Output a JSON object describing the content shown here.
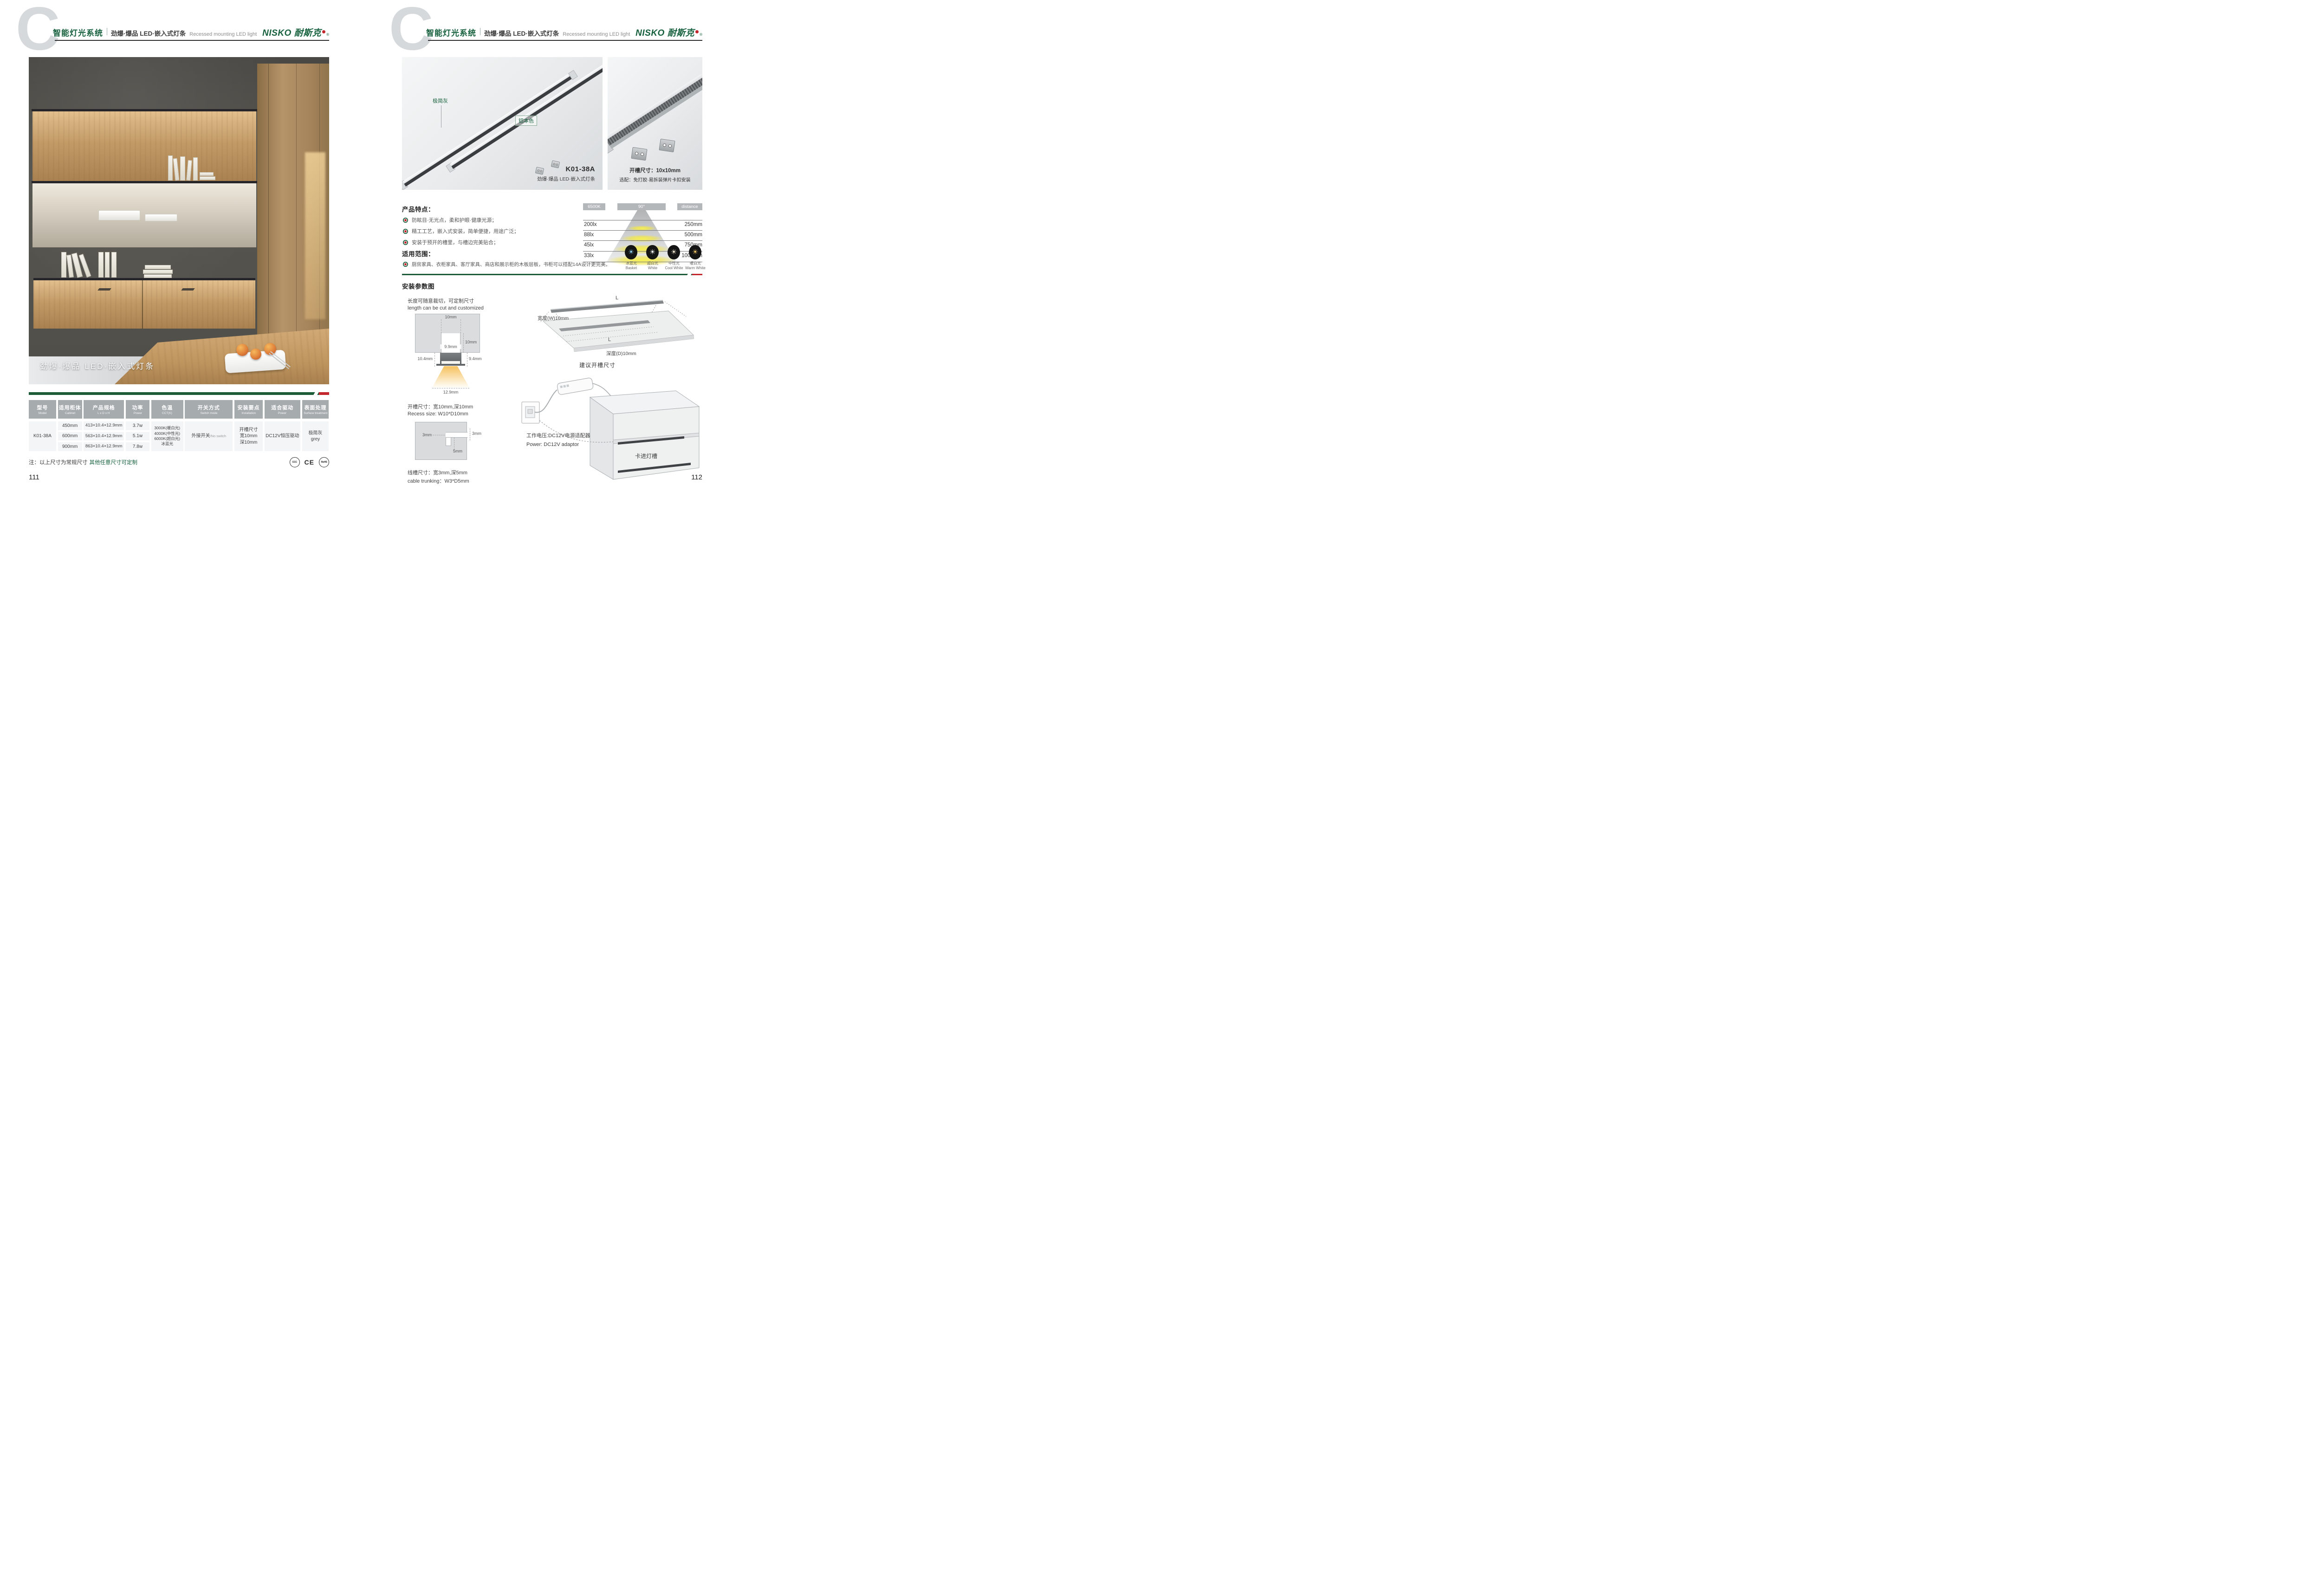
{
  "header": {
    "c_mark": "C",
    "title_zh": "智能灯光系统",
    "title_sub": "劲爆·爆品  LED·嵌入式灯条",
    "title_en": "Recessed mounting LED light",
    "logo_text": "NISKO 耐斯克",
    "logo_reg": "®"
  },
  "colors": {
    "brand_green": "#17613e",
    "accent_red": "#c1272d",
    "header_gray": "#a6abae",
    "cell_bg": "#f3f5f6"
  },
  "page_left": {
    "photo_caption": "劲爆·爆品 LED·嵌入式灯条",
    "table": {
      "headers": [
        {
          "zh": "型号",
          "en": "Model"
        },
        {
          "zh": "适用柜体",
          "en": "Cabinet"
        },
        {
          "zh": "产品规格",
          "en": "L x D x H"
        },
        {
          "zh": "功率",
          "en": "Power"
        },
        {
          "zh": "色温",
          "en": "CCT(K)"
        },
        {
          "zh": "开关方式",
          "en": "Switch mode"
        },
        {
          "zh": "安装要点",
          "en": "Installation"
        },
        {
          "zh": "适合驱动",
          "en": "Power"
        },
        {
          "zh": "表面处理",
          "en": "Surface treatment"
        }
      ],
      "model": "K01-38A",
      "variants": [
        {
          "cabinet": "450mm",
          "spec": "413×10.4×12.9mm",
          "power": "3.7w"
        },
        {
          "cabinet": "600mm",
          "spec": "563×10.4×12.9mm",
          "power": "5.1w"
        },
        {
          "cabinet": "900mm",
          "spec": "863×10.4×12.9mm",
          "power": "7.8w"
        }
      ],
      "cct_lines": [
        "3000K(暖白光)",
        "4000K(中性光)",
        "6000K(超白光)",
        "冰蓝光"
      ],
      "switch_zh": "外接开关",
      "switch_en": "/No switch",
      "install_lines": [
        "开槽尺寸",
        "宽10mm",
        "深10mm"
      ],
      "driver": "DC12V恒压驱动",
      "surface_lines": [
        "极简灰",
        "grey"
      ]
    },
    "note_prefix": "注：以上尺寸为常规尺寸",
    "note_green": "其他任意尺寸可定制",
    "certs": [
      "CCC",
      "CE",
      "RoHS"
    ],
    "page_number": "111"
  },
  "page_right": {
    "panel_main": {
      "label_gray": "极简灰",
      "label_aluminum": "铝本色",
      "model": "K01-38A",
      "model_sub": "劲爆·爆品 LED·嵌入式灯条"
    },
    "panel_detail": {
      "line1": "开槽尺寸：10x10mm",
      "line2": "选配：免打胶·易拆装弹片卡扣安装"
    },
    "features": {
      "title": "产品特点：",
      "items": [
        "防眩目·无光点，柔和护眼·健康光源；",
        "精工工艺，嵌入式安装，简单便捷，用途广泛；",
        "安装于预开的槽里，与槽边完美贴合；"
      ]
    },
    "scope": {
      "title": "适用范围：",
      "items": [
        "厨房家具、衣柜家具、客厅家具、商店和展示柜的木板层板，书柜可以搭配14A设计更完美。"
      ]
    },
    "light_chart": {
      "cct": "6500K",
      "angle": "90°",
      "distance_label": "distance",
      "rows": [
        {
          "lux": "200lx",
          "distance": "250mm"
        },
        {
          "lux": "88lx",
          "distance": "500mm"
        },
        {
          "lux": "45lx",
          "distance": "750mm"
        },
        {
          "lux": "33lx",
          "distance": "1000mm"
        }
      ]
    },
    "color_modes": [
      {
        "zh": "冰蓝光",
        "en": "Basket",
        "color": "#8ed0f2"
      },
      {
        "zh": "超白光",
        "en": "White",
        "color": "#ffffff"
      },
      {
        "zh": "中性光",
        "en": "Cool White",
        "color": "#f6ecd4"
      },
      {
        "zh": "暖白光",
        "en": "Warm White",
        "color": "#f2c568"
      }
    ],
    "install": {
      "title": "安装参数图",
      "cut_zh": "长度可随意裁切，可定制尺寸",
      "cut_en": "length can be cut and customized",
      "cross_dims": {
        "top_width": "10mm",
        "depth": "10mm",
        "inner_width": "9.9mm",
        "left_h": "10.4mm",
        "right_h": "9.4mm",
        "beam_width": "12.9mm"
      },
      "recess_zh": "开槽尺寸：宽10mm,深10mm",
      "recess_en": "Recess size: W10*D10mm",
      "cable_dims": {
        "entry": "3mm",
        "width": "3mm",
        "depth": "5mm"
      },
      "trunk_zh": "线槽尺寸：宽3mm,深5mm",
      "trunk_en": "cable trunking：W3*D5mm",
      "board": {
        "len_top": "L",
        "len_in": "L",
        "width_label": "宽度(W)10mm",
        "depth_label": "深度(D)10mm",
        "caption": "建议开槽尺寸"
      },
      "power_zh": "工作电压:DC12V电源适配器",
      "power_en": "Power: DC12V adaptor",
      "clip_label": "卡进灯槽"
    },
    "page_number": "112"
  },
  "chart_data": {
    "type": "table",
    "title": "6500K 90° beam illuminance vs distance",
    "cct": "6500K",
    "beam_angle": "90°",
    "columns": [
      "illuminance",
      "distance"
    ],
    "rows": [
      [
        "200lx",
        "250mm"
      ],
      [
        "88lx",
        "500mm"
      ],
      [
        "45lx",
        "750mm"
      ],
      [
        "33lx",
        "1000mm"
      ]
    ]
  }
}
